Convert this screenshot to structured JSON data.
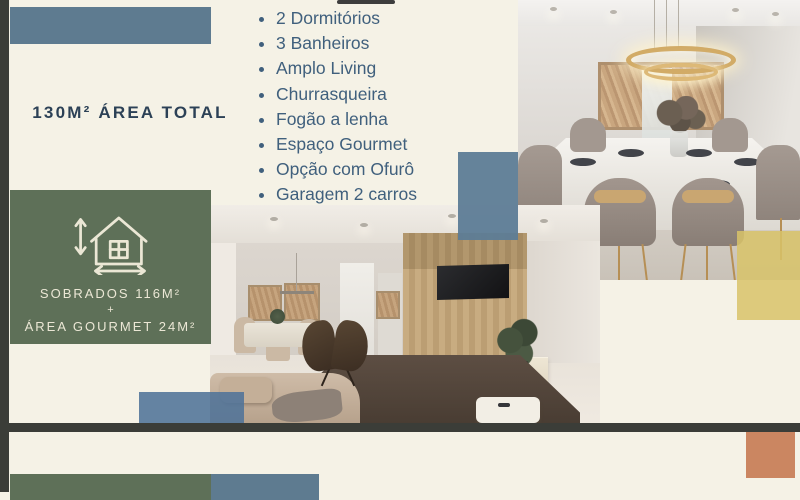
{
  "page": {
    "background": "#f5f2e6",
    "frame_color": "#3b3d38",
    "description": "Real-estate listing flyer slide"
  },
  "headline": {
    "text": "130M² ÁREA TOTAL",
    "color": "#2c4156"
  },
  "features": {
    "color": "#40607d",
    "items": [
      "2 Dormitórios",
      "3 Banheiros",
      "Amplo Living",
      "Churrasqueira",
      "Fogão a lenha",
      "Espaço Gourmet",
      "Opção com Ofurô",
      "Garagem 2 carros"
    ]
  },
  "area_badge": {
    "icon": "house-dimensions-icon",
    "line1": "SOBRADOS 116M²",
    "plus": "+",
    "line2": "ÁREA GOURMET 24M²",
    "bg": "#5e7058",
    "text_color": "#ebe7d5"
  },
  "photos": {
    "dining_room": {
      "label": "dining room interior render"
    },
    "living_room": {
      "label": "living room interior render"
    }
  },
  "accents": {
    "steel_blue": "#5e7b90",
    "green": "#5e7058",
    "yellow": "#d8c368",
    "orange": "#cb8661",
    "charcoal": "#3b3d38",
    "cream": "#f5f2e6"
  }
}
